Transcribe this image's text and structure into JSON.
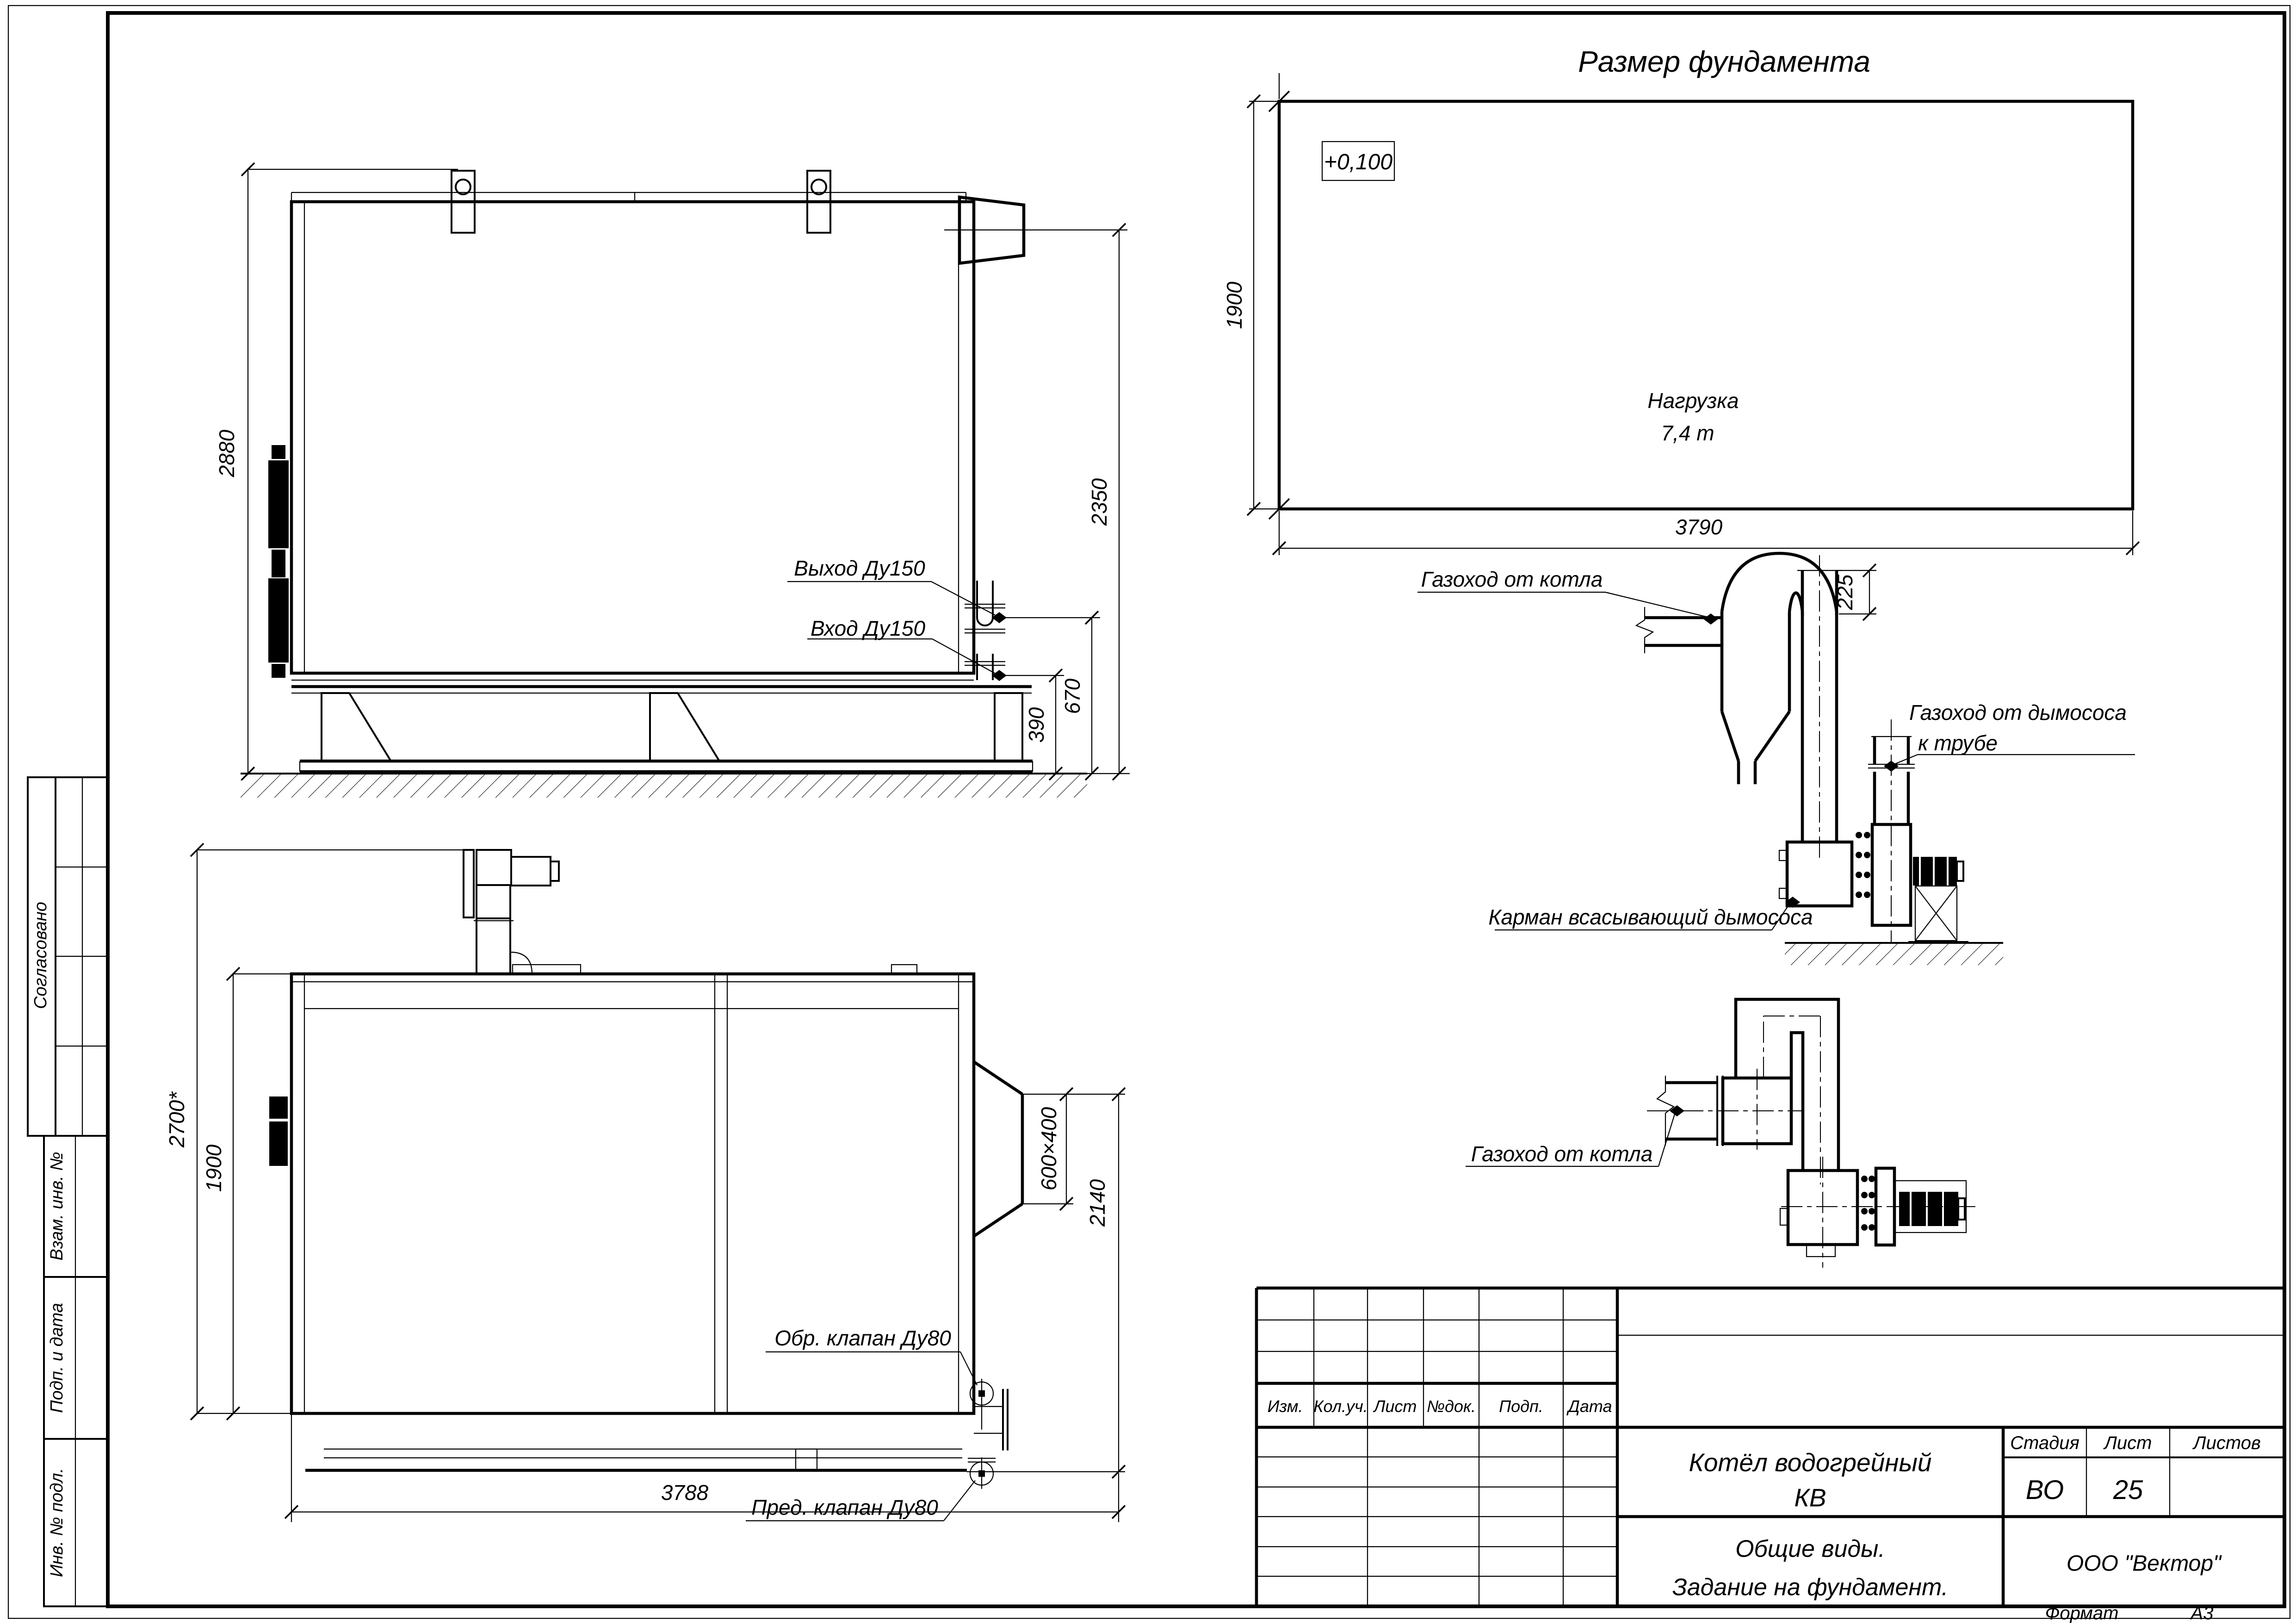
{
  "foundation": {
    "title": "Размер фундамента",
    "mark": "+0,100",
    "load1": "Нагрузка",
    "load2": "7,4 т",
    "dim_width": "1900",
    "dim_length": "3790"
  },
  "side": {
    "outlet": "Выход Ду150",
    "inlet": "Вход Ду150",
    "dim_height": "2880",
    "dim_flue": "2350",
    "dim_outlet": "670",
    "dim_inlet": "390"
  },
  "plan": {
    "valve_check": "Обр. клапан Ду80",
    "valve_safety": "Пред. клапан Ду80",
    "dim_overall": "2700*",
    "dim_width": "1900",
    "dim_duct": "600×400",
    "dim_offset": "2140",
    "dim_length": "3788"
  },
  "duct_elev": {
    "from_boiler": "Газоход от котла",
    "to_stack1": "Газоход от дымососа",
    "to_stack2": "к трубе",
    "pocket": "Карман всасывающий дымососа",
    "dim_stub": "225"
  },
  "duct_plan": {
    "from_boiler": "Газоход от котла"
  },
  "tb": {
    "t1": "Котёл водогрейный",
    "t2": "КВ",
    "s1": "Общие виды.",
    "s2": "Задание на фундамент.",
    "company": "ООО \"Вектор\"",
    "stage_l": "Стадия",
    "sheet_l": "Лист",
    "sheets_l": "Листов",
    "stage": "ВО",
    "sheet": "25",
    "sheets": "",
    "fmt_l": "Формат",
    "fmt": "А3",
    "rev": [
      "Изм.",
      "Кол.уч.",
      "Лист",
      "№док.",
      "Подп.",
      "Дата"
    ]
  },
  "side_bar": {
    "agreed": "Согласовано",
    "vzam": "Взам. инв. №",
    "podp": "Подп. и дата",
    "inv": "Инв. № подл."
  }
}
